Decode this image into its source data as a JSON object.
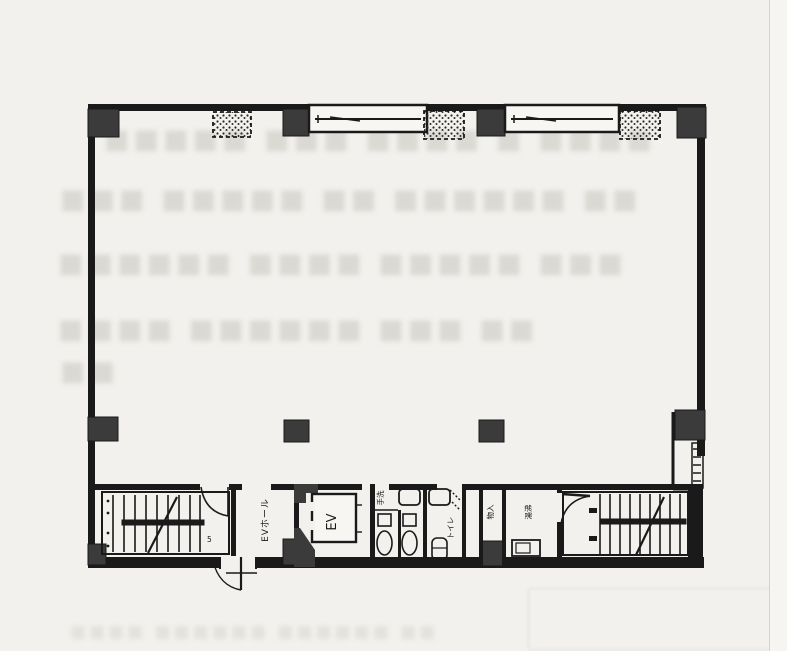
{
  "page": {
    "background": "#f2f1ed",
    "ink": "#1a1a1a",
    "column_color": "#3b3b3b",
    "ghost_color": "#dbd9d3"
  },
  "plan": {
    "labels": {
      "elevator_hall": "EVホール",
      "elevator": "EV",
      "toilet": "トイレ",
      "hand_wash": "手洗",
      "storage": "物入",
      "kitchenette": "湯沸",
      "stair_mark": "5"
    }
  },
  "showthrough": {
    "line1": "■■■■■ ■■■ ■■■■ ■ ■■■■",
    "line2": "■■■ ■■■■■ ■■ ■■■■■■ ■■",
    "line3": "■■■■■■ ■■■■ ■■■■■ ■■■",
    "line4": "■■■■ ■■■■■■ ■■■ ■■",
    "line5": "■■",
    "bottom": "■■■■ ■■■■■■ ■■■■■■ ■■"
  }
}
